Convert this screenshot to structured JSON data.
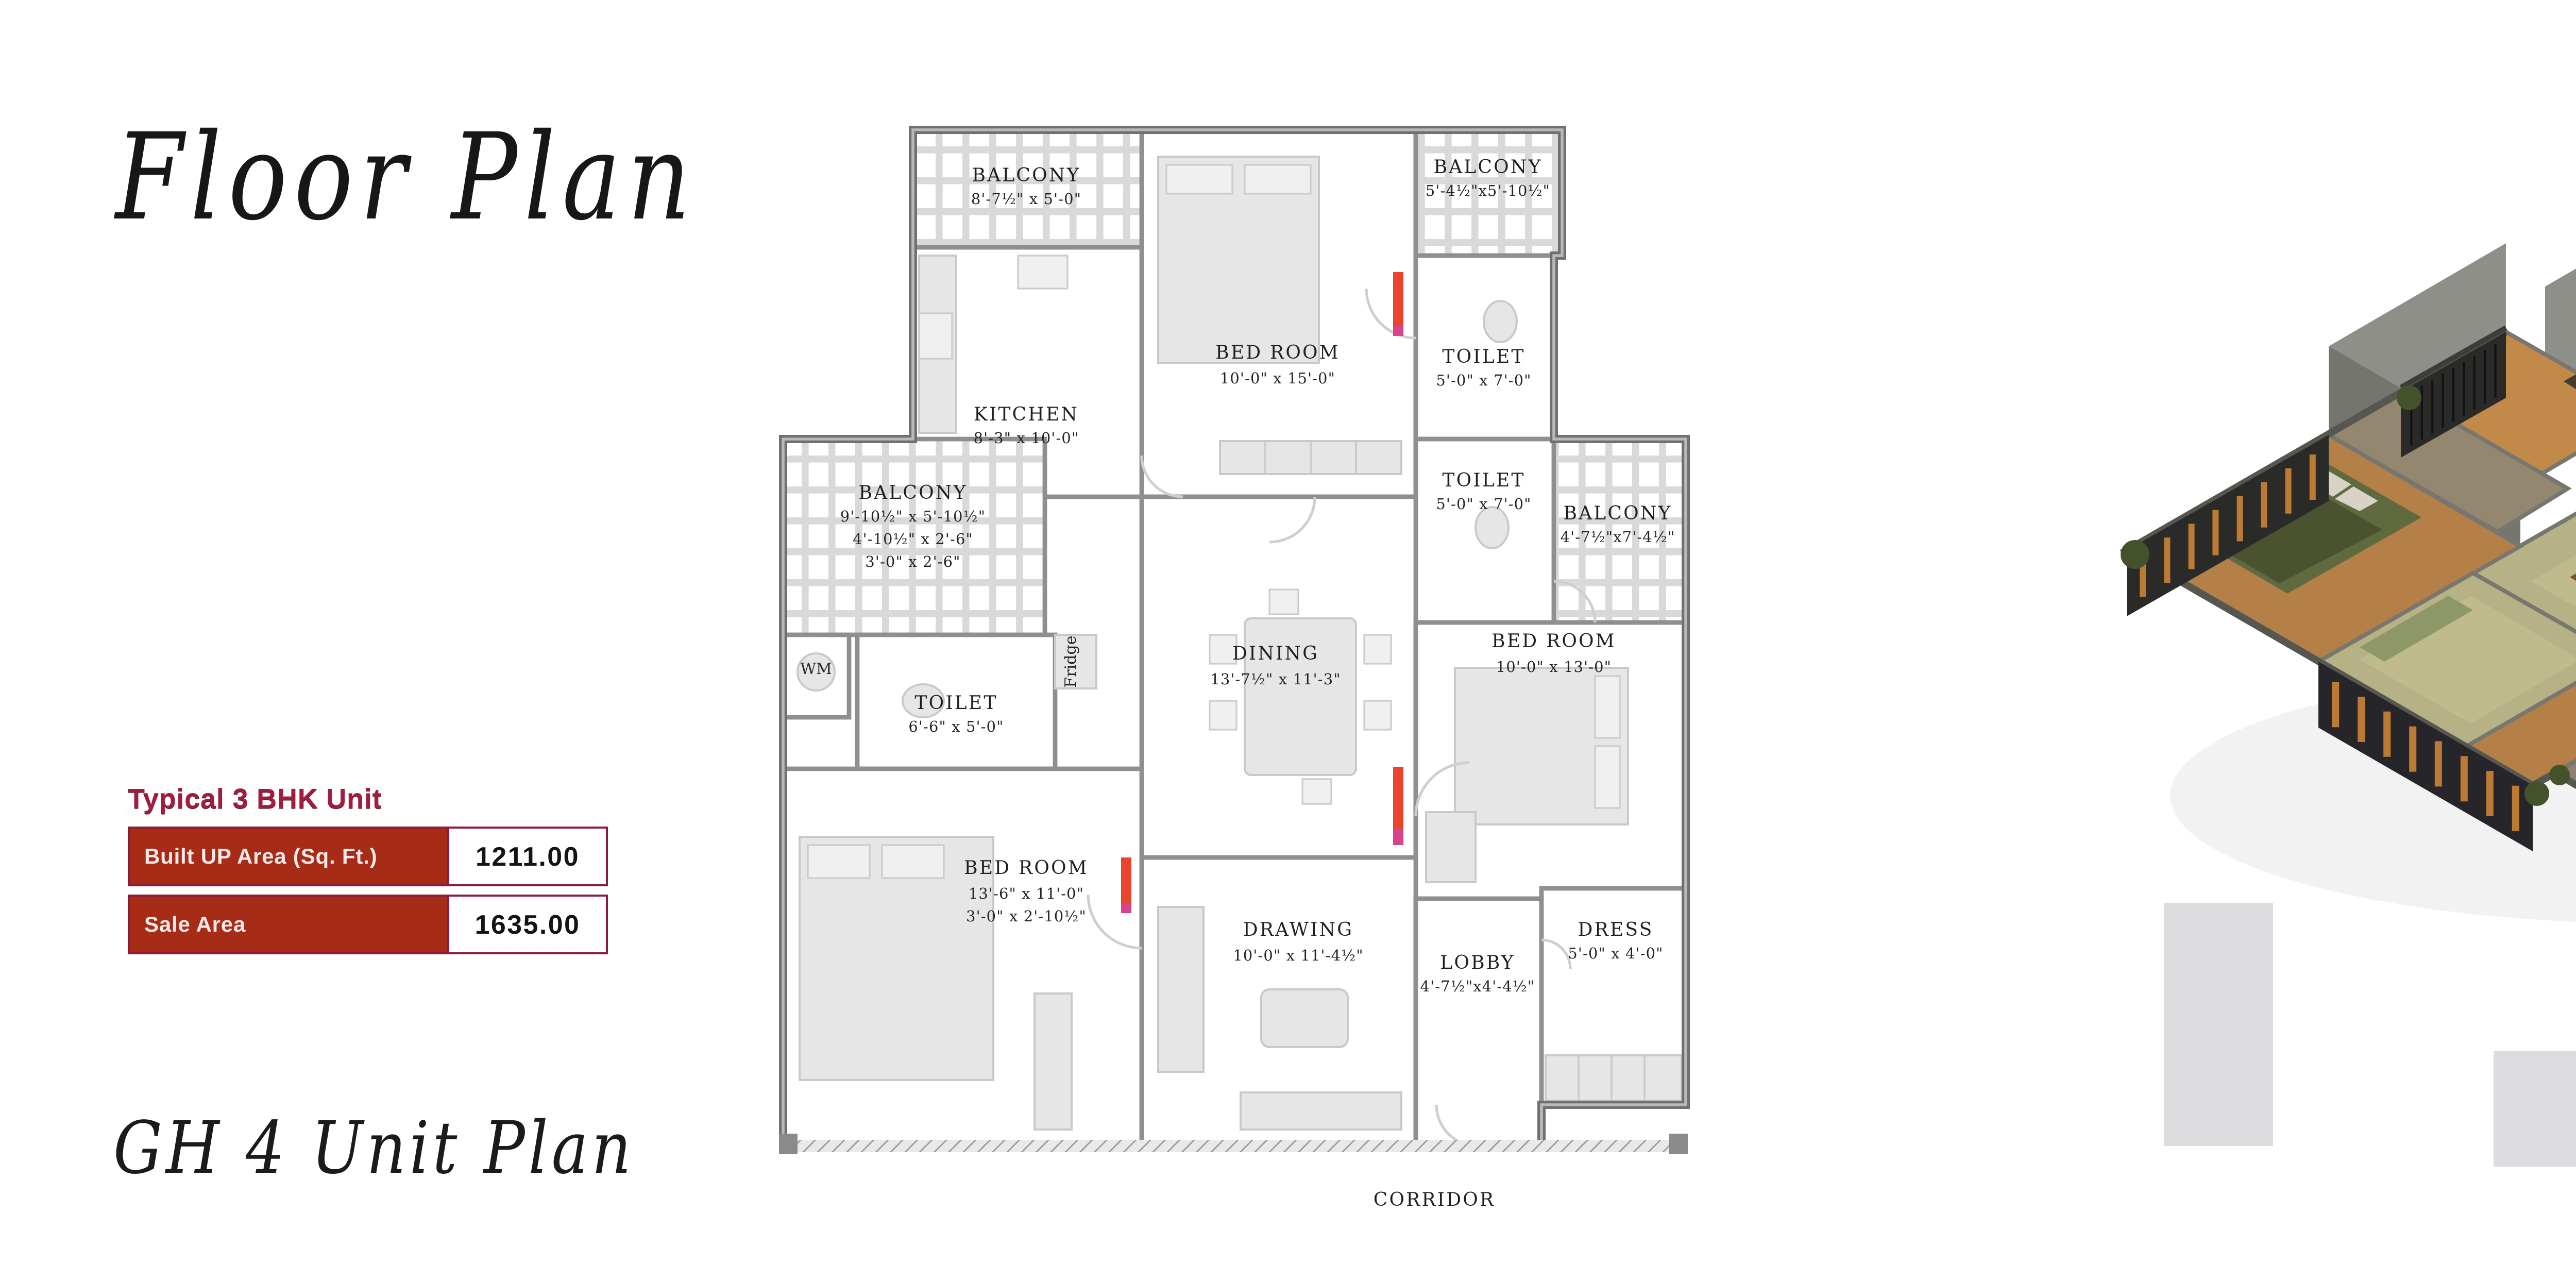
{
  "header": {
    "title": "Floor Plan"
  },
  "footer": {
    "script_label": "GH 4 Unit Plan"
  },
  "unit_info": {
    "heading": "Typical 3 BHK Unit",
    "rows": [
      {
        "label": "Built UP Area (Sq. Ft.)",
        "value": "1211.00"
      },
      {
        "label": "Sale Area",
        "value": "1635.00"
      }
    ]
  },
  "colors": {
    "heading_crimson": "#a21c40",
    "table_border_maroon": "#8c1b3a",
    "table_cell_brick": "#a62c17",
    "plan_wall_gray": "#8f8f8f",
    "door_marker_red": "#e8452c",
    "door_marker_magenta": "#d8448c",
    "render_wood": "#b58048",
    "render_olive_floor": "#b6b286",
    "render_wall_gray": "#7b7b75",
    "render_charcoal": "#2a2a28",
    "render_deck_orange": "#bd7a35",
    "backdrop_gray": "#dcdcde"
  },
  "plan": {
    "rooms": [
      {
        "name": "BALCONY",
        "dims": [
          "8'-7½\" x 5'-0\""
        ]
      },
      {
        "name": "KITCHEN",
        "dims": [
          "8'-3\" x 10'-0\""
        ]
      },
      {
        "name": "BED ROOM",
        "dims": [
          "10'-0\" x 15'-0\""
        ]
      },
      {
        "name": "BALCONY",
        "dims": [
          "5'-4½\"x5'-10½\""
        ]
      },
      {
        "name": "TOILET",
        "dims": [
          "5'-0\" x 7'-0\""
        ]
      },
      {
        "name": "TOILET",
        "dims": [
          "5'-0\" x 7'-0\""
        ]
      },
      {
        "name": "BALCONY",
        "dims": [
          "4'-7½\"x7'-4½\""
        ]
      },
      {
        "name": "BALCONY",
        "dims": [
          "9'-10½\" x 5'-10½\"",
          "4'-10½\" x 2'-6\"",
          "3'-0\" x 2'-6\""
        ]
      },
      {
        "name": "WM",
        "dims": []
      },
      {
        "name": "TOILET",
        "dims": [
          "6'-6\" x 5'-0\""
        ]
      },
      {
        "name": "Fridge",
        "dims": []
      },
      {
        "name": "DINING",
        "dims": [
          "13'-7½\" x 11'-3\""
        ]
      },
      {
        "name": "BED ROOM",
        "dims": [
          "10'-0\" x 13'-0\""
        ]
      },
      {
        "name": "BED ROOM",
        "dims": [
          "13'-6\" x 11'-0\"",
          "3'-0\" x 2'-10½\""
        ]
      },
      {
        "name": "DRAWING",
        "dims": [
          "10'-0\" x 11'-4½\""
        ]
      },
      {
        "name": "LOBBY",
        "dims": [
          "4'-7½\"x4'-4½\""
        ]
      },
      {
        "name": "DRESS",
        "dims": [
          "5'-0\" x 4'-0\""
        ]
      }
    ],
    "corridor_label": "CORRIDOR"
  }
}
